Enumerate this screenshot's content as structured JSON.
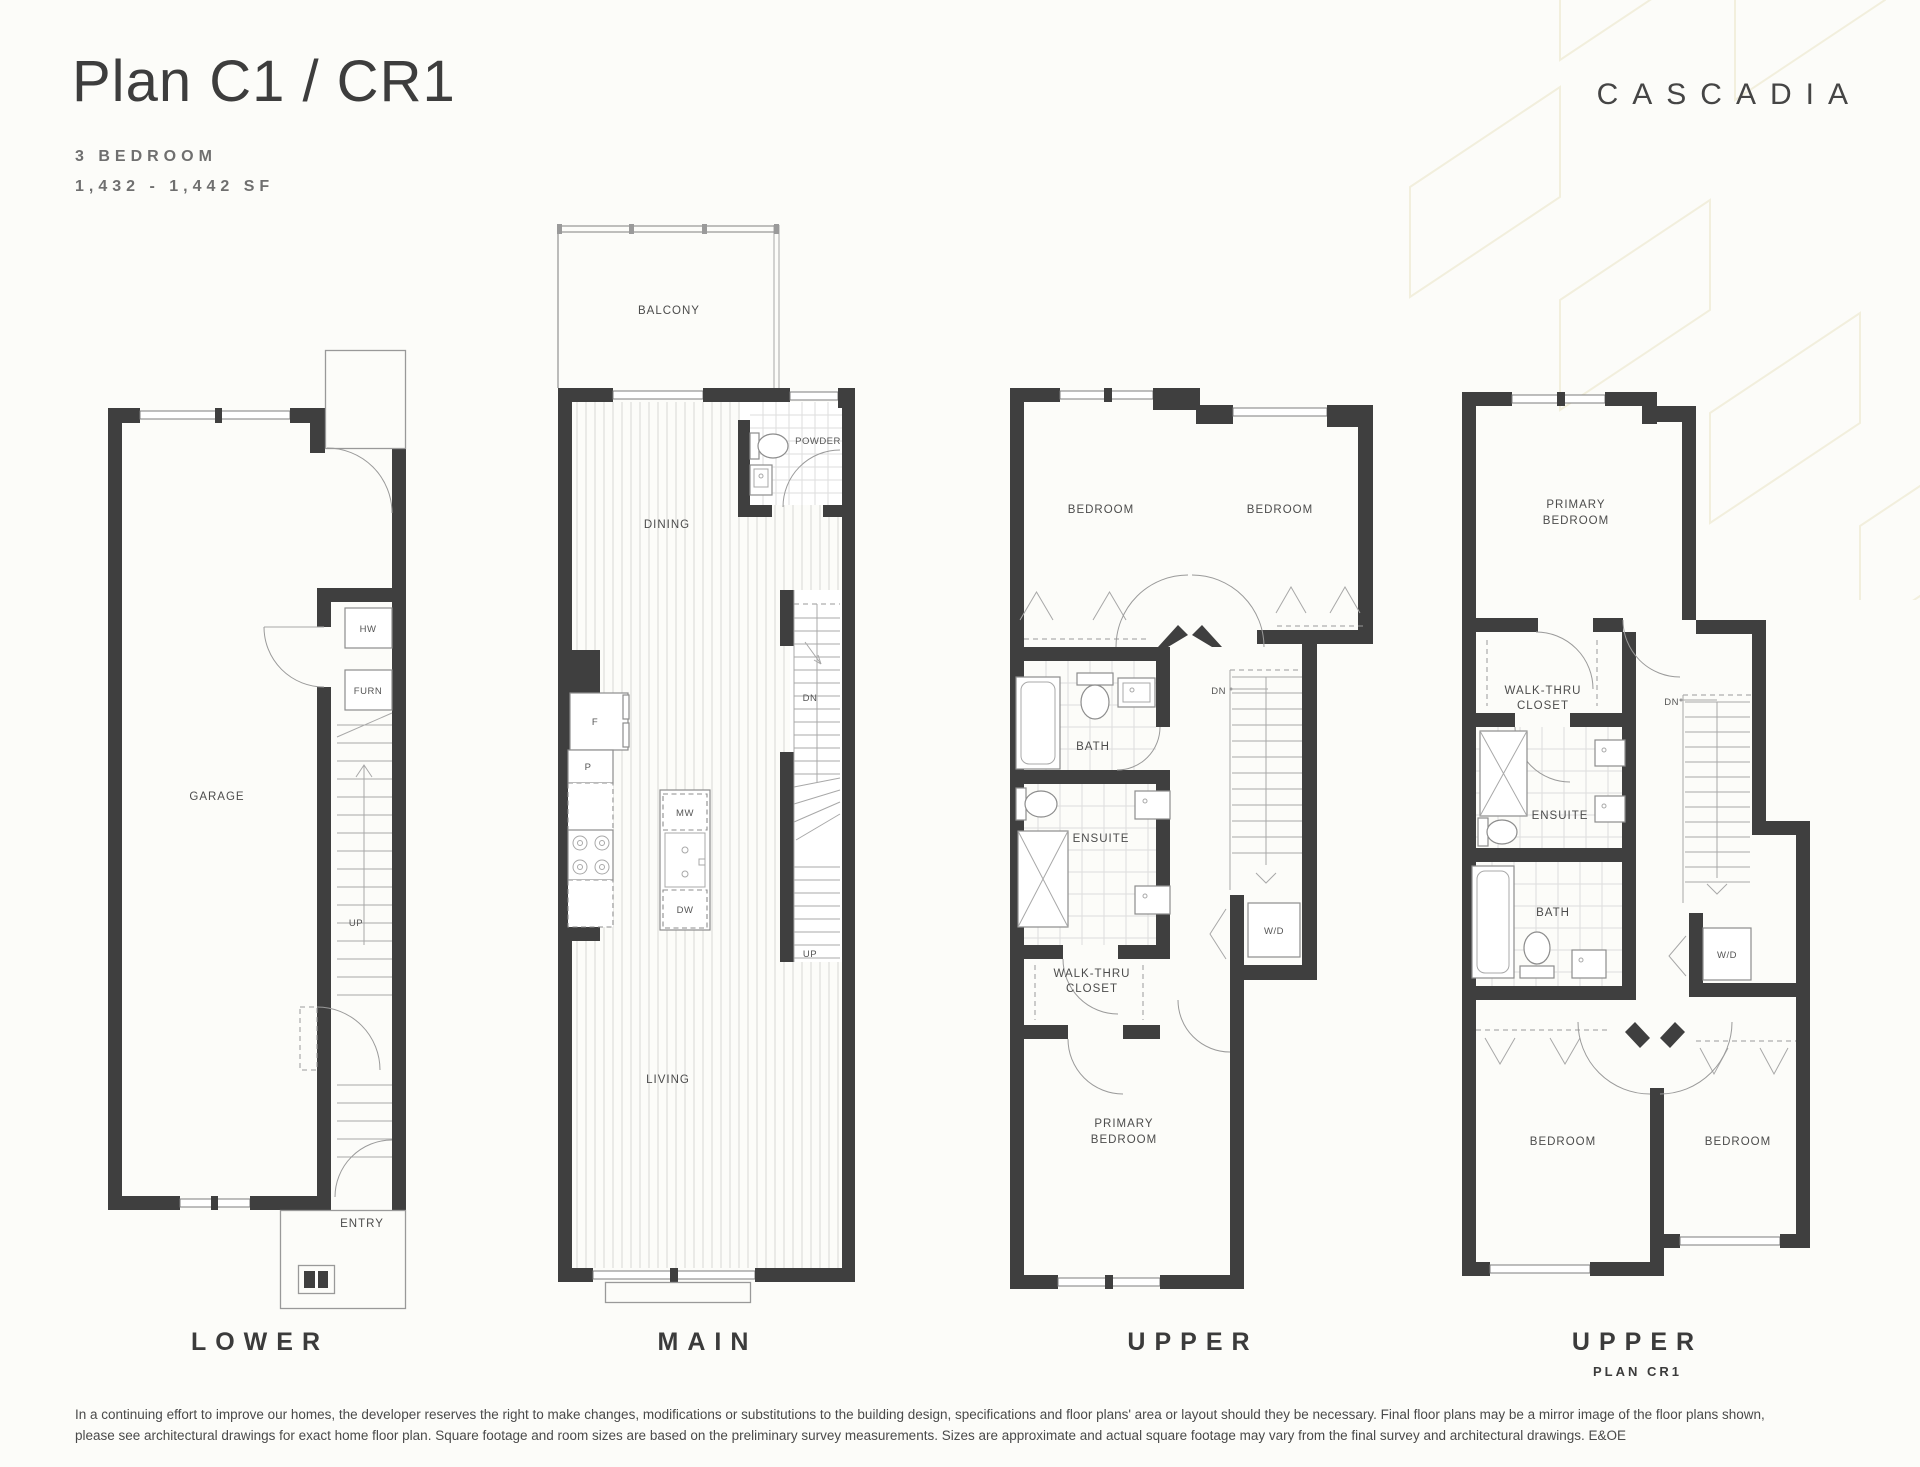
{
  "header": {
    "title": "Plan C1 / CR1",
    "subtitle_line1": "3 BEDROOM",
    "subtitle_line2": "1,432 - 1,442 SF",
    "brand": "CASCADIA"
  },
  "plans": {
    "lower": {
      "caption": "LOWER",
      "garage": "GARAGE",
      "hw": "HW",
      "furn": "FURN",
      "up": "UP",
      "entry": "ENTRY"
    },
    "main": {
      "caption": "MAIN",
      "balcony": "BALCONY",
      "powder": "POWDER",
      "dining": "DINING",
      "living": "LIVING",
      "fridge": "F",
      "pantry": "P",
      "microwave": "MW",
      "dishwasher": "DW",
      "down": "DN",
      "up": "UP"
    },
    "upper": {
      "caption": "UPPER",
      "bedroom_left": "BEDROOM",
      "bedroom_right": "BEDROOM",
      "bath": "BATH",
      "ensuite": "ENSUITE",
      "walkthru_l1": "WALK-THRU",
      "walkthru_l2": "CLOSET",
      "washer_dryer": "W/D",
      "down": "DN",
      "primary_l1": "PRIMARY",
      "primary_l2": "BEDROOM"
    },
    "upper_cr1": {
      "caption": "UPPER",
      "subcaption": "PLAN CR1",
      "primary_l1": "PRIMARY",
      "primary_l2": "BEDROOM",
      "walkthru_l1": "WALK-THRU",
      "walkthru_l2": "CLOSET",
      "ensuite": "ENSUITE",
      "bath": "BATH",
      "washer_dryer": "W/D",
      "down": "DN",
      "bedroom_left": "BEDROOM",
      "bedroom_right": "BEDROOM"
    }
  },
  "footer": {
    "disclaimer_line1": "In a continuing effort to improve our homes, the developer reserves the right to make changes, modifications or substitutions to the building design, specifications and floor plans' area or layout should they be necessary. Final floor plans may be a mirror image of the floor plans shown,",
    "disclaimer_line2": "please see architectural drawings for exact home floor plan. Square footage and room sizes are based on the preliminary survey measurements. Sizes are approximate and actual square footage may vary from the final survey and architectural drawings. E&OE"
  },
  "colors": {
    "wall": "#3f3f3f",
    "thin_line": "#999999",
    "text": "#4c4c4c",
    "background": "#fcfcf9",
    "pattern": "#f2efdd"
  }
}
